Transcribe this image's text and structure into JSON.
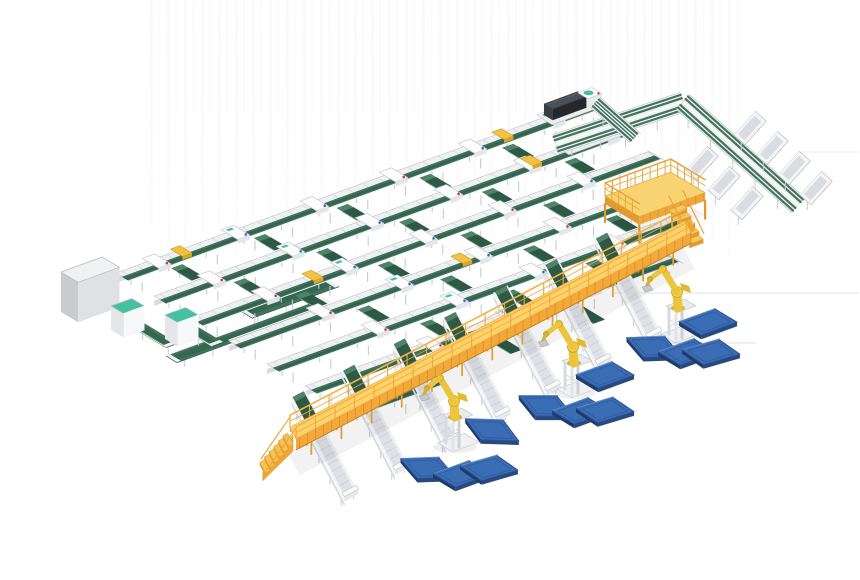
{
  "meta": {
    "description": "3D isometric rendering of an automated logistics sortation system with green belt conveyors, an elevated yellow walkway, yellow palletizing robot arms and blue pallets",
    "background": "#ffffff",
    "width": 860,
    "height": 580
  },
  "palette": {
    "beltGreen": "#41745D",
    "beltGreenDark": "#2E5A47",
    "beltGreenDeep": "#2D5945",
    "beltGreenLight": "#4F8368",
    "mint": "#45C1A1",
    "frameLight": "#EFF0F2",
    "frameSide": "#D8DBDF",
    "frameEdge": "#B9BEC5",
    "frameMid": "#C7CBD1",
    "walkYellow": "#F2A93A",
    "walkYellowLight": "#FFD26B",
    "walkYellowDark": "#D9912B",
    "robotYellow": "#ECC53C",
    "robotYellowDark": "#C9A125",
    "palletBlue": "#3A6DB4",
    "palletBlueDark": "#27497E",
    "palletBlueDeep": "#1E3C6B",
    "machineTop": "#4A5058",
    "machineSide": "#24272C",
    "machineFace": "#383D43",
    "dotBlue": "#2F6CD0",
    "dotRed": "#CE3A2F",
    "floorLine": "#DADBDD",
    "shadow": "#000000"
  },
  "iso": {
    "u": [
      0.94,
      -0.342
    ],
    "v": [
      0.857,
      0.515
    ],
    "u2": [
      0.949,
      -0.314
    ],
    "v2": [
      0.743,
      0.669
    ],
    "n": [
      0.669,
      -0.743
    ],
    "w": [
      0.887,
      -0.4635
    ],
    "p": [
      0.4635,
      0.887
    ]
  },
  "labels": {
    "scene": "factory-isometric-render",
    "sorter": "sorter-grid",
    "line": "sorter-line-conveyor",
    "chute": "transfer-chute",
    "carriage": "divert-carriage",
    "yellowUnit": "scanner-unit",
    "spur": "palletizing-outfeed-conveyor",
    "walkway": "elevated-maintenance-walkway",
    "stairs": "walkway-stairs",
    "robot": "palletizing-robot-arm",
    "pallet": "blue-pallet",
    "machine": "case-sealing-machine",
    "connector": "end-connector-conveyor",
    "collector": "outfeed-collector-conveyor",
    "bin": "gravity-discharge-bin",
    "mezzanine": "operator-mezzanine-platform",
    "grayBox": "infeed-machine-cabinet",
    "cabinet": "control-cabinet",
    "loop": "supply-belt-loop",
    "floor": "floor-shadow-line"
  },
  "sorter": {
    "line_width": 15,
    "chute_step": 88,
    "chute_start": 44,
    "carriage_step": 84,
    "lines": [
      {
        "x": 116,
        "y": 277,
        "len": 505
      },
      {
        "x": 154,
        "y": 300,
        "len": 500
      },
      {
        "x": 191,
        "y": 322,
        "len": 486
      },
      {
        "x": 229,
        "y": 345,
        "len": 464
      },
      {
        "x": 267,
        "y": 368,
        "len": 437
      },
      {
        "x": 305,
        "y": 390,
        "len": 384
      },
      {
        "x": 342,
        "y": 413,
        "len": 95
      }
    ],
    "yellow_units": [
      {
        "line": 0,
        "at": 58
      },
      {
        "line": 0,
        "at": 400
      },
      {
        "line": 1,
        "at": 390
      },
      {
        "line": 2,
        "at": 118
      },
      {
        "line": 3,
        "at": 236
      }
    ]
  },
  "spurs": {
    "count": 7,
    "t0": 30,
    "step": 57,
    "back": 46,
    "fwd": 68,
    "width": 15
  },
  "walkway": {
    "S": [
      293,
      453
    ],
    "E": [
      688,
      247
    ],
    "deck_half": 6.5,
    "height": 20,
    "rail_h": 12,
    "steps": 6
  },
  "robots": [
    [
      453,
      444
    ],
    [
      572,
      390
    ],
    [
      676,
      335
    ]
  ],
  "pallets": [
    [
      428,
      468,
      18
    ],
    [
      462,
      474,
      0
    ],
    [
      489,
      468,
      4
    ],
    [
      492,
      430,
      22
    ],
    [
      546,
      406,
      20
    ],
    [
      581,
      411,
      0
    ],
    [
      605,
      410,
      3
    ],
    [
      605,
      375,
      0
    ],
    [
      654,
      347,
      18
    ],
    [
      687,
      352,
      0
    ],
    [
      711,
      352,
      4
    ],
    [
      708,
      322,
      0
    ]
  ],
  "machines": [
    {
      "at": [
        541,
        122
      ],
      "len": 52
    },
    {
      "at": [
        558,
        152
      ],
      "len": 56
    }
  ],
  "connector": {
    "from": [
      596,
      106
    ],
    "to": [
      634,
      140
    ]
  },
  "collector": {
    "seg1": [
      [
        556,
        147
      ],
      [
        683,
        105
      ]
    ],
    "seg2": [
      [
        683,
        105
      ],
      [
        798,
        208
      ]
    ],
    "width": 20
  },
  "bins": [
    [
      750,
      131,
      1
    ],
    [
      772,
      151,
      1
    ],
    [
      794,
      171,
      1
    ],
    [
      816,
      191,
      1
    ],
    [
      702,
      166,
      -1
    ],
    [
      724,
      186,
      -1
    ],
    [
      747,
      206,
      -1
    ]
  ],
  "mezzanine": {
    "corner": [
      605,
      196
    ],
    "u_len": 70,
    "v_len": 40,
    "depth": 8,
    "leg": 26,
    "fence_h": 13
  },
  "left": {
    "gray_box": {
      "at": [
        61,
        272
      ],
      "u": 44,
      "v": 20,
      "h": 40
    },
    "cabinets": [
      {
        "at": [
          111,
          306
        ],
        "u": 22,
        "v": 15,
        "h": 24
      },
      {
        "at": [
          165,
          315
        ],
        "u": 22,
        "v": 15,
        "h": 24
      }
    ],
    "belts": [
      {
        "from": [
          125,
          325
        ],
        "dir": "v",
        "len": 48,
        "w": 12
      },
      {
        "from": [
          166,
          358
        ],
        "dir": "u",
        "len": 168,
        "w": 13
      },
      {
        "from": [
          181,
          330
        ],
        "dir": "v",
        "len": 36,
        "w": 12
      },
      {
        "from": [
          237,
          311
        ],
        "dir": "u",
        "len": 92,
        "w": 18
      }
    ]
  },
  "floor_lines": [
    [
      612,
      293,
      858,
      293,
      0.8
    ],
    [
      627,
      343,
      756,
      343,
      0.8
    ],
    [
      798,
      152,
      858,
      152,
      0.5
    ]
  ]
}
